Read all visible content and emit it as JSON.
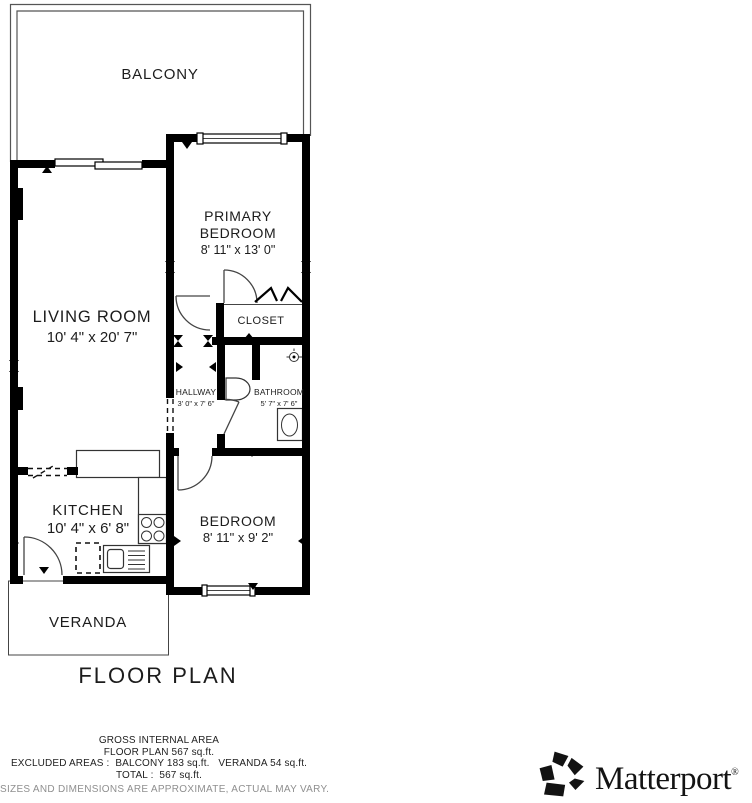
{
  "plan": {
    "title": "FLOOR PLAN",
    "rooms": {
      "balcony": {
        "name": "BALCONY"
      },
      "living_room": {
        "name": "LIVING ROOM",
        "dims": "10' 4\" x 20' 7\""
      },
      "primary_bedroom": {
        "name_line1": "PRIMARY",
        "name_line2": "BEDROOM",
        "dims": "8' 11\" x 13' 0\""
      },
      "closet": {
        "name": "CLOSET"
      },
      "hallway": {
        "name": "HALLWAY",
        "dims": "3' 0\" x 7' 6\""
      },
      "bathroom": {
        "name": "BATHROOM",
        "dims": "5' 7\" x 7' 6\""
      },
      "kitchen": {
        "name": "KITCHEN",
        "dims": "10' 4\" x 6' 8\""
      },
      "bedroom": {
        "name": "BEDROOM",
        "dims": "8' 11\" x 9' 2\""
      },
      "veranda": {
        "name": "VERANDA"
      }
    }
  },
  "footer": {
    "gross_internal_area": "GROSS INTERNAL AREA",
    "floor_plan_area": "FLOOR PLAN 567 sq.ft.",
    "excluded_areas": "EXCLUDED AREAS :  BALCONY 183 sq.ft.   VERANDA 54 sq.ft.",
    "total": "TOTAL :  567 sq.ft.",
    "disclaimer": "SIZES AND DIMENSIONS ARE APPROXIMATE, ACTUAL MAY VARY."
  },
  "branding": {
    "logo_text": "Matterport",
    "registered_mark": "®"
  },
  "colors": {
    "wall": "#000000",
    "label_text": "#1c1c1c",
    "disclaimer_text": "#8f8f8f",
    "background": "#ffffff"
  }
}
